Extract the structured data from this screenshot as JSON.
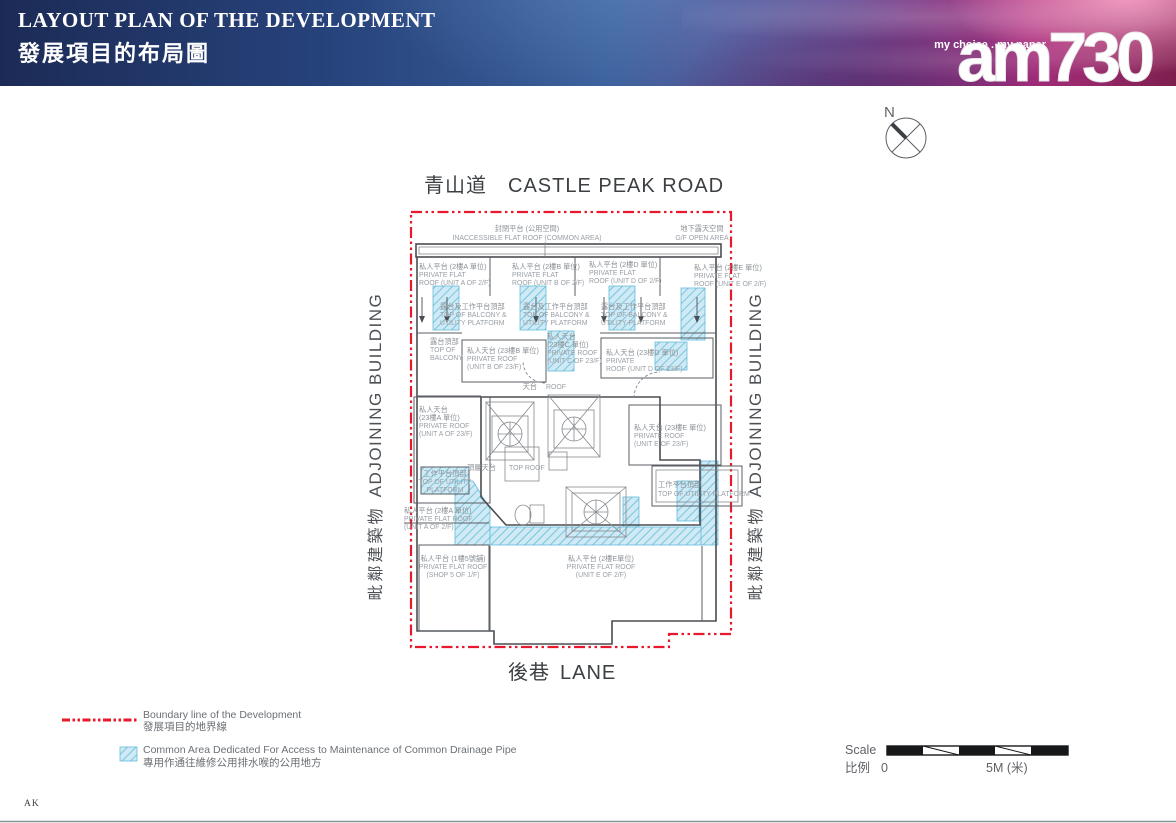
{
  "header": {
    "title_en": "LAYOUT PLAN OF THE DEVELOPMENT",
    "title_zh": "發展項目的布局圖",
    "tagline": "my choice . my paper",
    "brand": "am730"
  },
  "compass": {
    "north": "N"
  },
  "roads": {
    "top_zh": "青山道",
    "top_en": "CASTLE PEAK ROAD",
    "bottom_zh": "後巷",
    "bottom_en": "LANE",
    "adjoining_en": "ADJOINING BUILDING",
    "adjoining_zh": "毗鄰建築物"
  },
  "plan": {
    "inaccessible": [
      "封閉平台 (公用空間)",
      "INACCESSIBLE FLAT ROOF (COMMON AREA)"
    ],
    "gf_open": [
      "地下露天空間",
      "G/F OPEN AREA"
    ],
    "pfr_a_2f_top": [
      "私人平台 (2樓A 單位)",
      "PRIVATE FLAT",
      "ROOF (UNIT A OF 2/F)"
    ],
    "pfr_b_2f": [
      "私人平台 (2樓B 單位)",
      "PRIVATE FLAT",
      "ROOF (UNIT B OF 2/F)"
    ],
    "pfr_d_2f": [
      "私人平台 (2樓D 單位)",
      "PRIVATE FLAT",
      "ROOF (UNIT D OF 2/F)"
    ],
    "pfr_e_2f_top": [
      "私人平台 (2樓E 單位)",
      "PRIVATE FLAT",
      "ROOF (UNIT E OF 2/F)"
    ],
    "bal_util": [
      "露台及工作平台頂部",
      "TOP OF BALCONY &",
      "UTILITY PLATFORM"
    ],
    "top_balcony": [
      "露台頂部",
      "TOP OF",
      "BALCONY"
    ],
    "pr_b_23f": [
      "私人天台 (23樓B 單位)",
      "PRIVATE ROOF",
      "(UNIT B OF 23/F)"
    ],
    "pr_c_23f": [
      "私人天台",
      "(23樓C 單位)",
      "PRIVATE ROOF",
      "(UNIT C OF 23/F)"
    ],
    "pr_d_23f": [
      "私人天台 (23樓D 單位)",
      "PRIVATE",
      "ROOF (UNIT D OF 23/F)"
    ],
    "roof_zh": "天台",
    "roof_en": "ROOF",
    "pr_a_23f": [
      "私人天台",
      "(23樓A 單位)",
      "PRIVATE ROOF",
      "(UNIT A OF 23/F)"
    ],
    "pr_e_23f": [
      "私人天台 (23樓E 單位)",
      "PRIVATE ROOF",
      "(UNIT E OF 23/F)"
    ],
    "top_roof_zh": "頂層天台",
    "top_roof_en": "TOP ROOF",
    "util_left": [
      "工作平台頂部",
      "TOP OF UTILITY",
      "PLATFORM"
    ],
    "util_right": [
      "工作平台頂部",
      "TOP OF UTILITY PLATFORM"
    ],
    "pfr_a_2f_mid": [
      "私人平台 (2樓A 單位)",
      "PRIVATE FLAT ROOF",
      "(UNIT A OF 2/F)"
    ],
    "pfr_shop5": [
      "私人平台 (1樓5號舖)",
      "PRIVATE FLAT ROOF",
      "(SHOP 5 OF 1/F)"
    ],
    "pfr_e_2f_bottom": [
      "私人平台 (2樓E單位)",
      "PRIVATE FLAT ROOF",
      "(UNIT E OF 2/F)"
    ]
  },
  "legend": {
    "boundary_en": "Boundary line of the Development",
    "boundary_zh": "發展項目的地界線",
    "common_en": "Common Area Dedicated For Access to Maintenance of Common Drainage Pipe",
    "common_zh": "專用作通往維修公用排水喉的公用地方"
  },
  "scale": {
    "label_en": "Scale",
    "label_zh": "比例",
    "zero": "0",
    "max": "5M (米)"
  },
  "footer": {
    "mark": "AK"
  },
  "colors": {
    "boundary_line": "#e8192c",
    "hatch_fill": "#cfeaf5",
    "hatch_stroke": "#62bbda",
    "plan_line": "#4a4d52",
    "label_text": "#9aa0a6",
    "header_navy": "#1c2b56",
    "header_magenta": "#a62d7c"
  }
}
